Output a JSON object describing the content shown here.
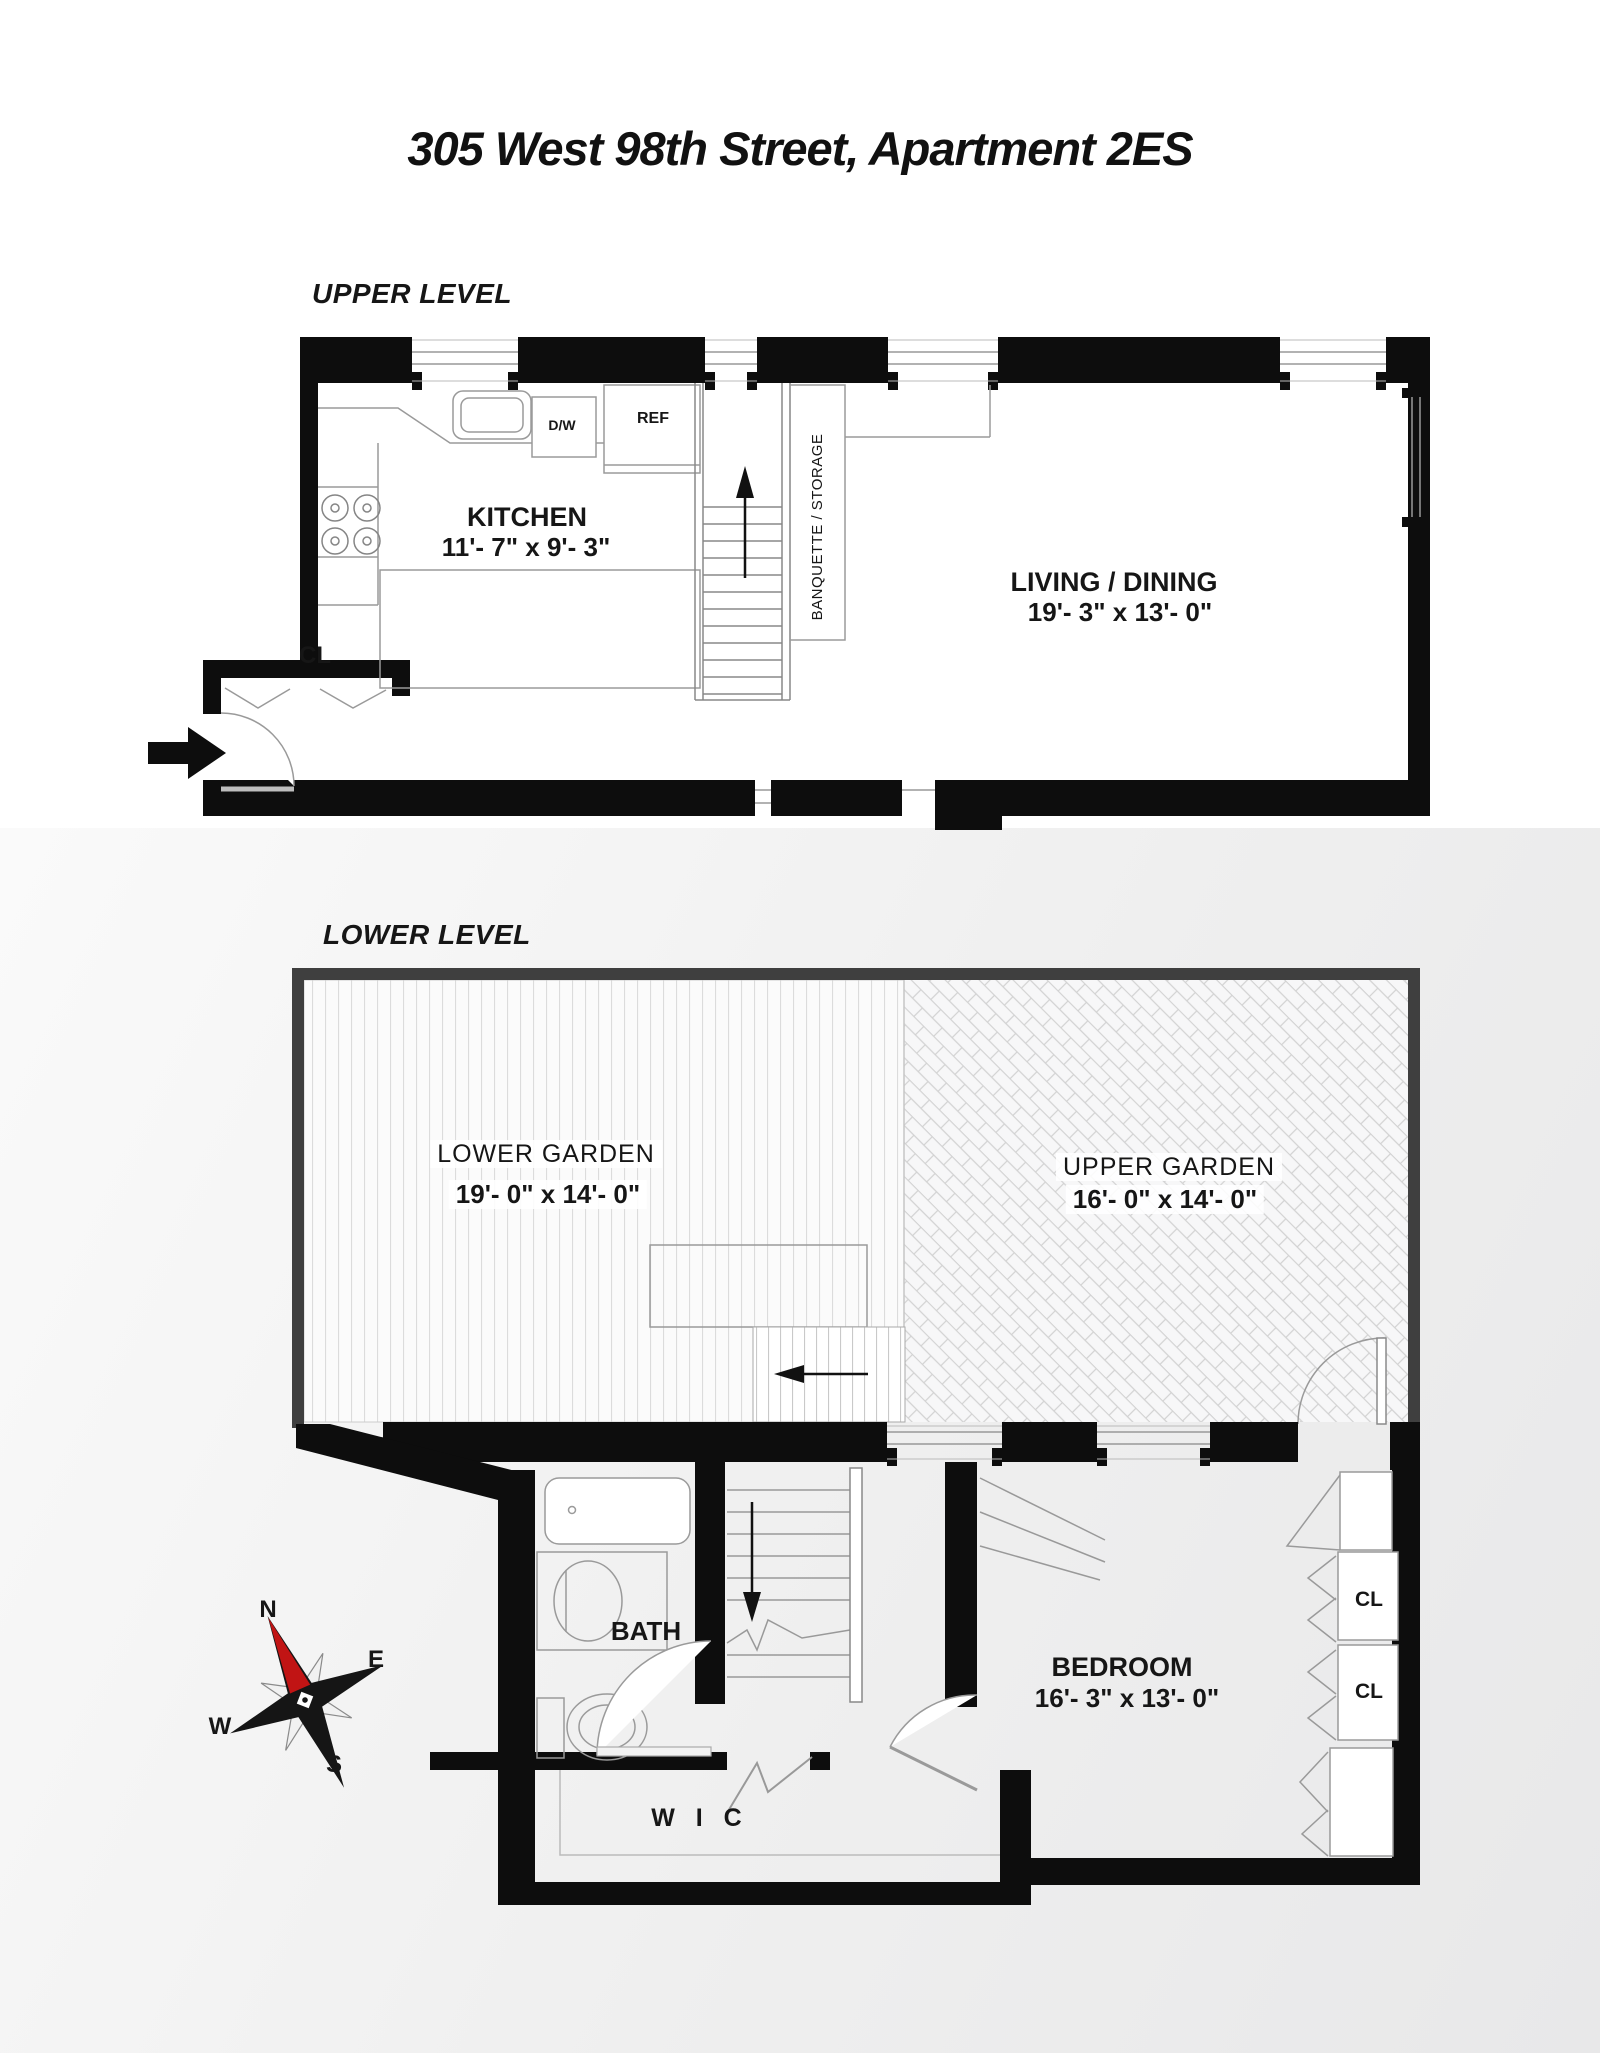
{
  "page": {
    "title": "305 West 98th Street, Apartment 2ES"
  },
  "upper_level": {
    "label": "UPPER LEVEL",
    "kitchen": {
      "name": "KITCHEN",
      "dims": "11'- 7\" x 9'- 3\""
    },
    "living_dining": {
      "name": "LIVING / DINING",
      "dims": "19'- 3\" x 13'- 0\""
    },
    "banquette": {
      "name": "BANQUETTE / STORAGE"
    },
    "appliances": {
      "dishwasher": "D/W",
      "refrigerator": "REF"
    },
    "closet": {
      "name": "CL"
    }
  },
  "lower_level": {
    "label": "LOWER LEVEL",
    "lower_garden": {
      "name": "LOWER GARDEN",
      "dims": "19'- 0\" x 14'- 0\""
    },
    "upper_garden": {
      "name": "UPPER GARDEN",
      "dims": "16'- 0\" x 14'- 0\""
    },
    "bath": {
      "name": "BATH"
    },
    "bedroom": {
      "name": "BEDROOM",
      "dims": "16'- 3\" x 13'- 0\""
    },
    "wic": {
      "name": "W I C"
    },
    "closet_1": "CL",
    "closet_2": "CL"
  },
  "compass": {
    "north": "N",
    "east": "E",
    "west": "W",
    "south": "S"
  },
  "colors": {
    "wall": "#0d0d0d",
    "garden_wall": "#3f3f3f",
    "line": "#999999",
    "north_needle": "#c11414"
  }
}
